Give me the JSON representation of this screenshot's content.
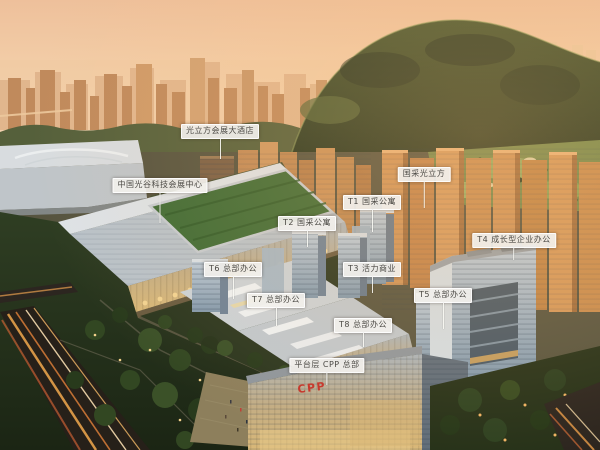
{
  "callouts": [
    {
      "id": "hotel",
      "text": "光立方会展大酒店"
    },
    {
      "id": "exhibition-center",
      "text": "中国光谷科技会展中心"
    },
    {
      "id": "project-name",
      "text": "国采光立方"
    },
    {
      "id": "t1",
      "text": "T1 国采公寓"
    },
    {
      "id": "t2",
      "text": "T2 国采公寓"
    },
    {
      "id": "t3",
      "text": "T3 活力商业"
    },
    {
      "id": "t4",
      "text": "T4 成长型企业办公"
    },
    {
      "id": "t5",
      "text": "T5 总部办公"
    },
    {
      "id": "t6",
      "text": "T6 总部办公"
    },
    {
      "id": "t7",
      "text": "T7 总部办公"
    },
    {
      "id": "t8",
      "text": "T8 总部办公"
    },
    {
      "id": "platform-cpp",
      "text": "平台层 CPP 总部"
    }
  ],
  "building_sign": {
    "text": "CPP"
  },
  "colors": {
    "label_background": "#f2f0eb",
    "label_text": "#4c4a45",
    "callout_line": "#f7f5f0",
    "sky": "#f0c6a0",
    "hill_green": "#3c4a2b",
    "roof_green": "#3e6b35",
    "glass_blue": "#9db0c2",
    "sunset_orange": "#cd9356",
    "sign_red": "#c4332a"
  }
}
